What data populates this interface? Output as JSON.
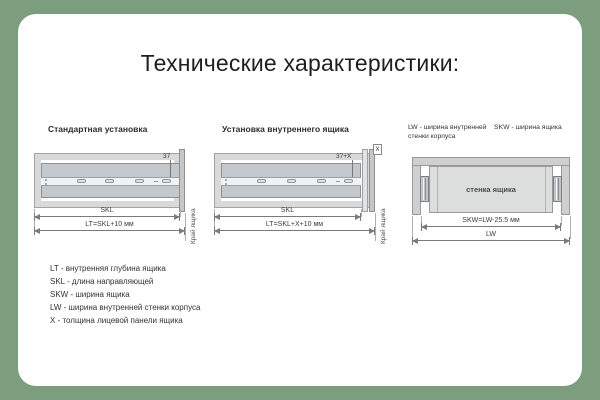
{
  "colors": {
    "frame_green": "#7d9d7f",
    "card_bg": "#ffffff",
    "panel_gray": "#d9d9d9",
    "slide_gray": "#c3c8cc",
    "dim_line": "#7a7a7a"
  },
  "title": "Технические характеристики:",
  "diagram1": {
    "title": "Стандартная установка",
    "dim_hole": "37",
    "dim_skl": "SKL",
    "dim_lt": "LT=SKL+10 мм",
    "edge_label": "Край ящика"
  },
  "diagram2": {
    "title": "Установка внутреннего ящика",
    "dim_hole": "37+X",
    "dim_x": "X",
    "dim_skl": "SKL",
    "dim_lt": "LT=SKL+X+10 мм",
    "edge_label": "Край ящика"
  },
  "diagram3": {
    "note_lw": "LW - ширина внутренней стенки корпуса",
    "note_skw": "SKW - ширина ящика",
    "drawer_label": "стенка ящика",
    "dim_skw": "SKW=LW-25.5 мм",
    "dim_lw": "LW"
  },
  "legend": {
    "items": [
      "LT - внутренняя глубина ящика",
      "SKL - длина направляющей",
      "SKW - ширина ящика",
      "LW - ширина внутренней стенки корпуса",
      "X - толщина лицевой панели ящика"
    ]
  }
}
